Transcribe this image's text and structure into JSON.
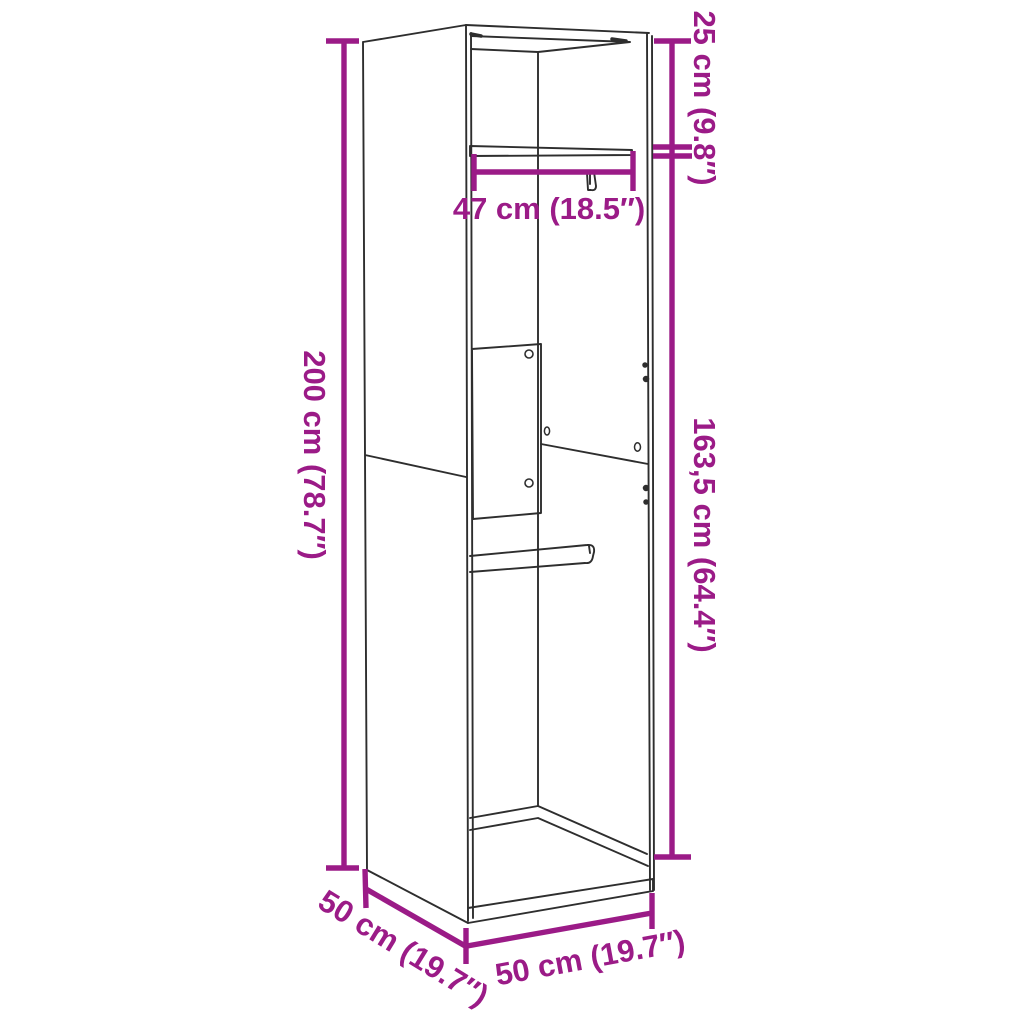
{
  "colors": {
    "dimension": "#9b1b87",
    "line_art": "#2e2e2e",
    "background": "#ffffff"
  },
  "diagram": {
    "labels": {
      "height_top_section": "25 cm (9.8″)",
      "rail_length": "47 cm (18.5″)",
      "height_total": "200 cm (78.7″)",
      "height_below_rail": "163,5 cm (64.4″)",
      "depth": "50 cm (19.7″)",
      "width": "50 cm (19.7″)"
    }
  }
}
